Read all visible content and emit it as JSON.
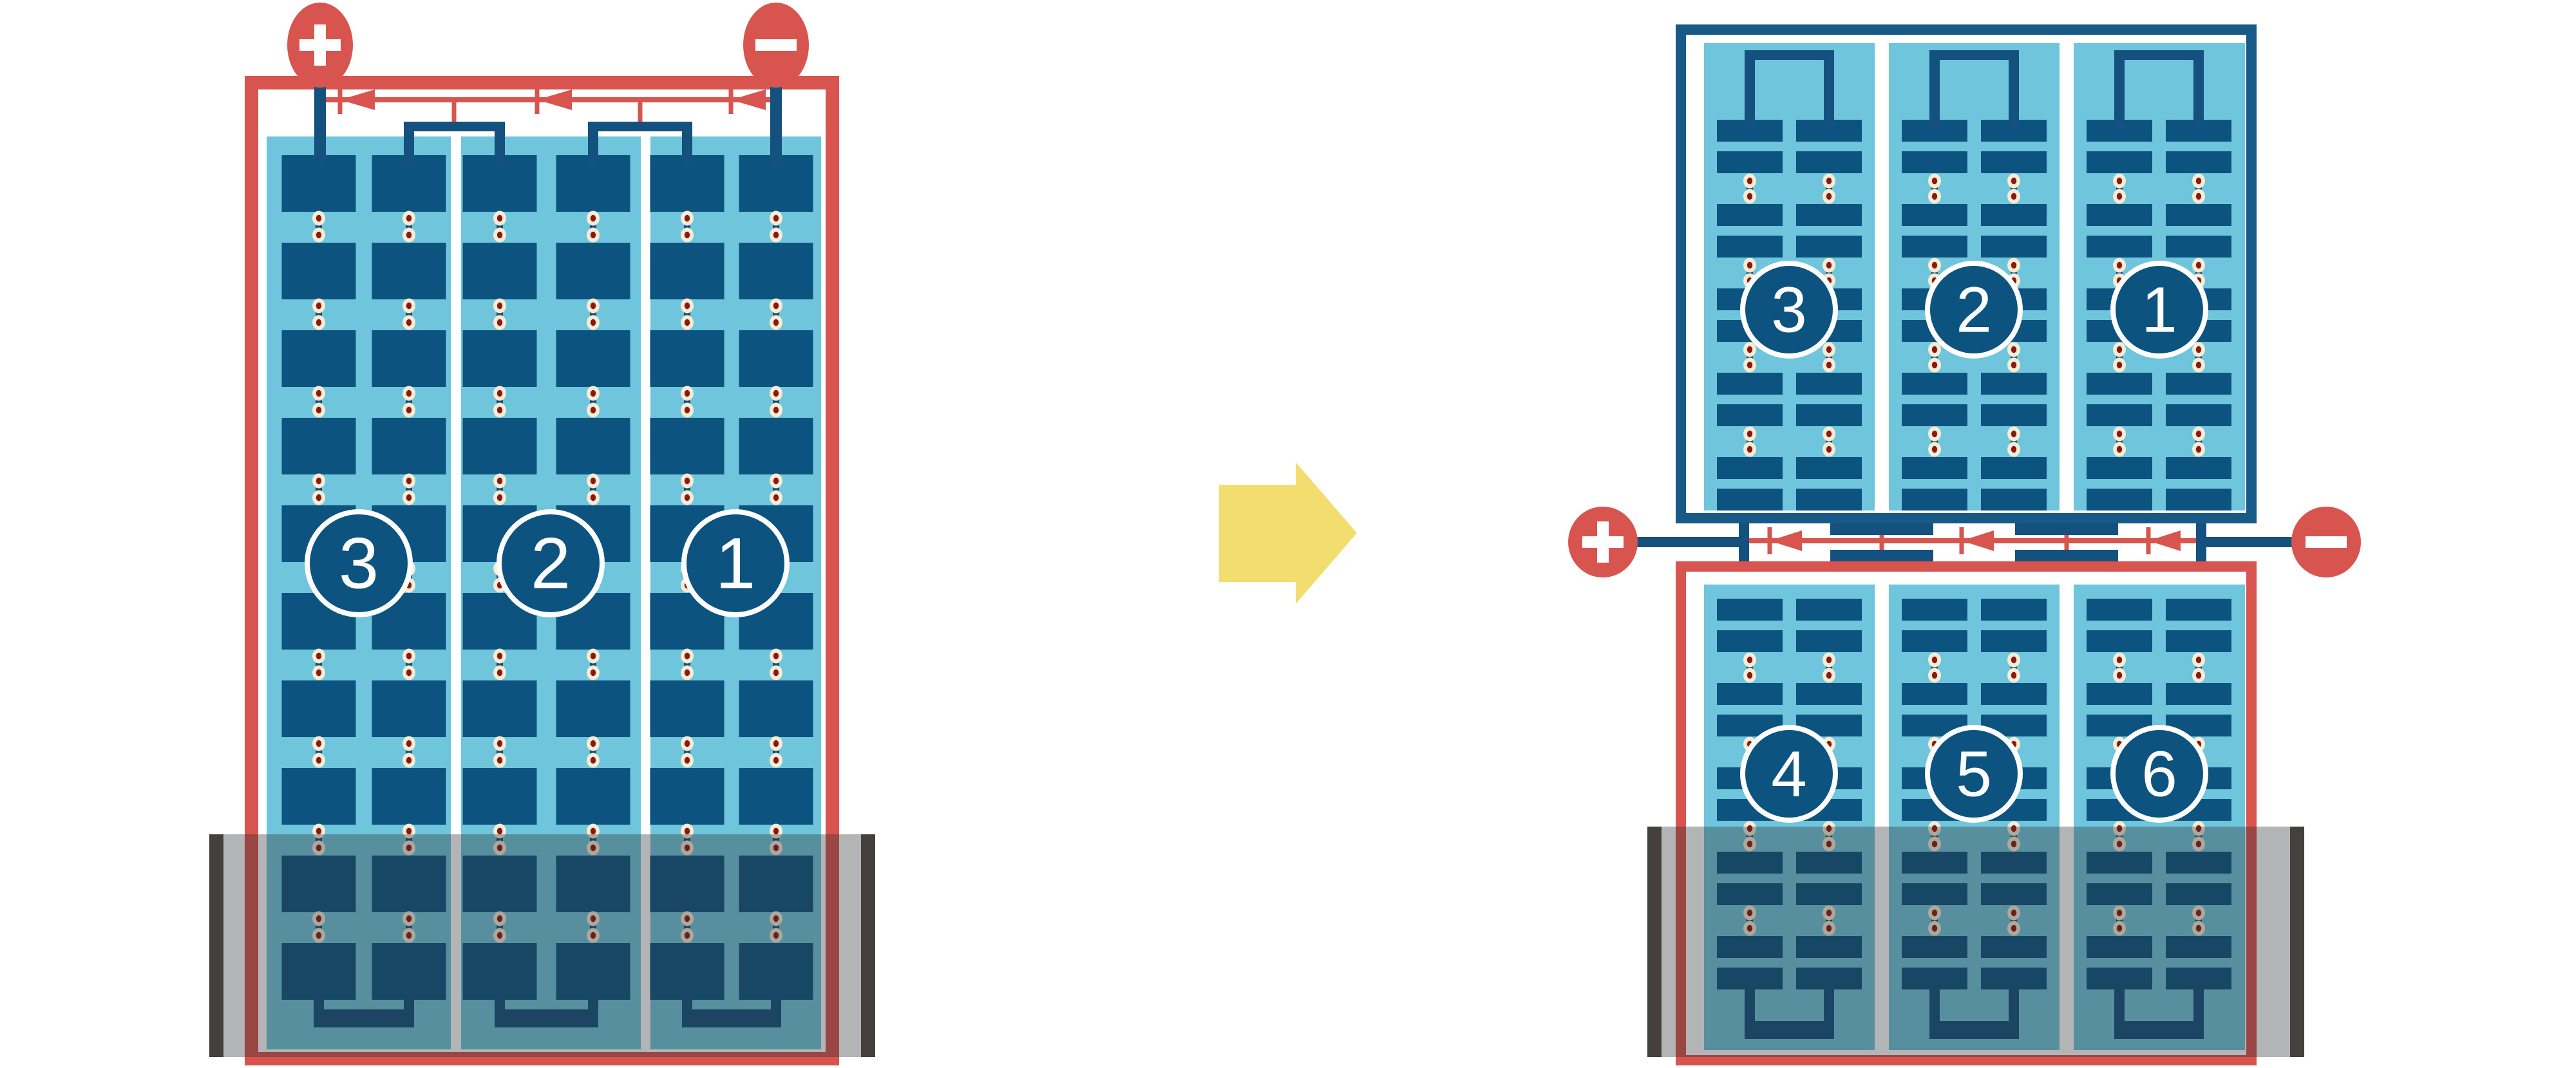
{
  "diagram": {
    "left_module": {
      "terminal_plus_symbol": "+",
      "terminal_minus_symbol": "−",
      "string_labels": [
        "3",
        "2",
        "1"
      ],
      "strings": 3,
      "bypass_diodes": 3
    },
    "right_module": {
      "terminal_plus_symbol": "+",
      "terminal_minus_symbol": "−",
      "top_string_labels": [
        "3",
        "2",
        "1"
      ],
      "bottom_string_labels": [
        "4",
        "5",
        "6"
      ],
      "strings": 6,
      "bypass_diodes": 3
    },
    "icons": [
      "plus-terminal-icon",
      "minus-terminal-icon",
      "bypass-diode-icon",
      "transition-arrow-icon",
      "flood-wall-icon"
    ]
  },
  "colors": {
    "red": "#D8544F",
    "red_dark_dot": "#8C1815",
    "navy_wire": "#14517E",
    "navy_cell": "#0D5380",
    "navy_border": "#175A88",
    "light_blue": "#6FC6DC",
    "cream": "#F6ECD3",
    "wall_gray": "#43403D",
    "overlay": "rgba(44,48,53,0.36)",
    "arrow_yellow": "#F2DE6E",
    "white": "#FFFFFF"
  }
}
